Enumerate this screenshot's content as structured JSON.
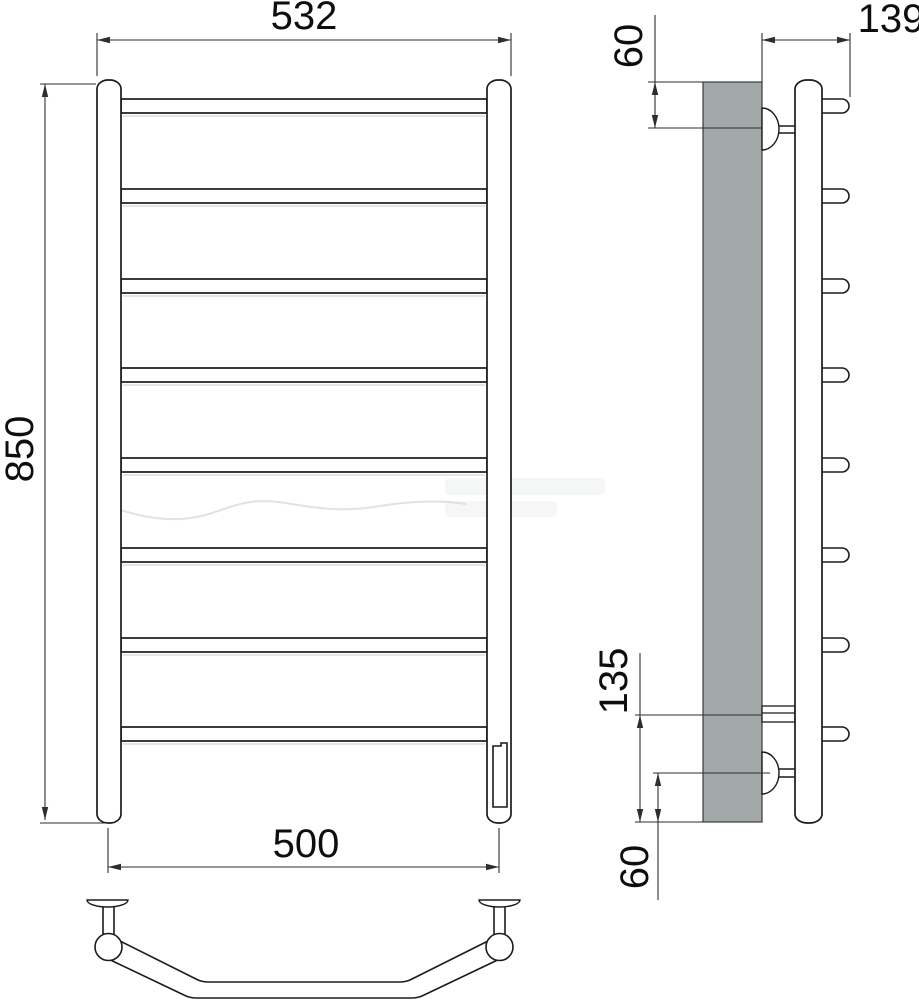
{
  "drawing": {
    "kind": "ladder-towel-rail-technical-drawing",
    "dims": {
      "overall_width": "532",
      "overall_height": "850",
      "mounting_width": "500",
      "depth_from_wall": "139",
      "top_bracket_offset": "60",
      "element_connection_offset": "135",
      "bottom_bracket_offset": "60"
    },
    "colors": {
      "wall": "#a3a8a8",
      "outline": "#1b1b1b",
      "dimension": "#2e2e2e"
    }
  }
}
